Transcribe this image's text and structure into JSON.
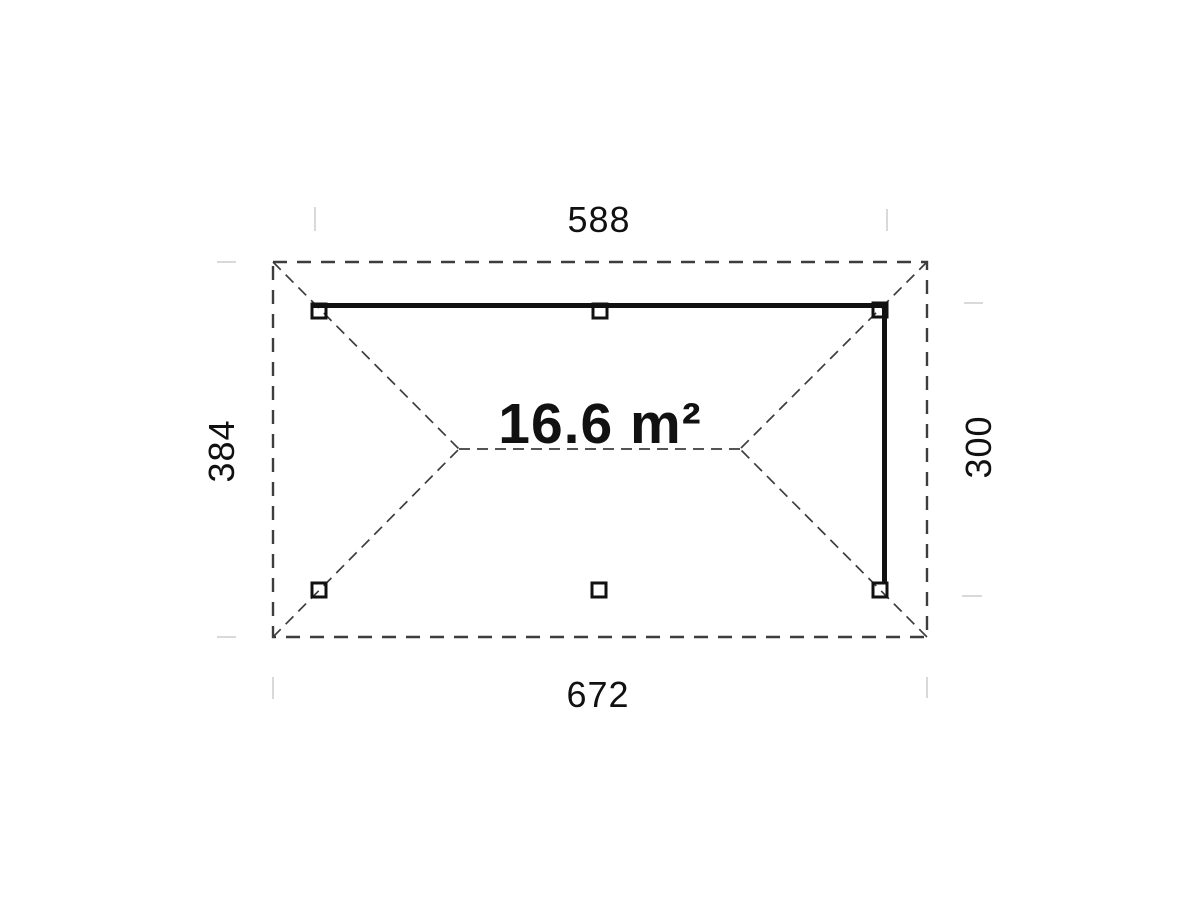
{
  "plan": {
    "area_label": "16.6 m²",
    "dimensions": {
      "top": "588",
      "bottom": "672",
      "left": "384",
      "right": "300"
    },
    "posts_count": 6,
    "colors": {
      "background": "#ffffff",
      "solid_line": "#111111",
      "dashed_line": "#3d3d3d",
      "tick": "#d9d9d9",
      "text": "#111111"
    }
  }
}
